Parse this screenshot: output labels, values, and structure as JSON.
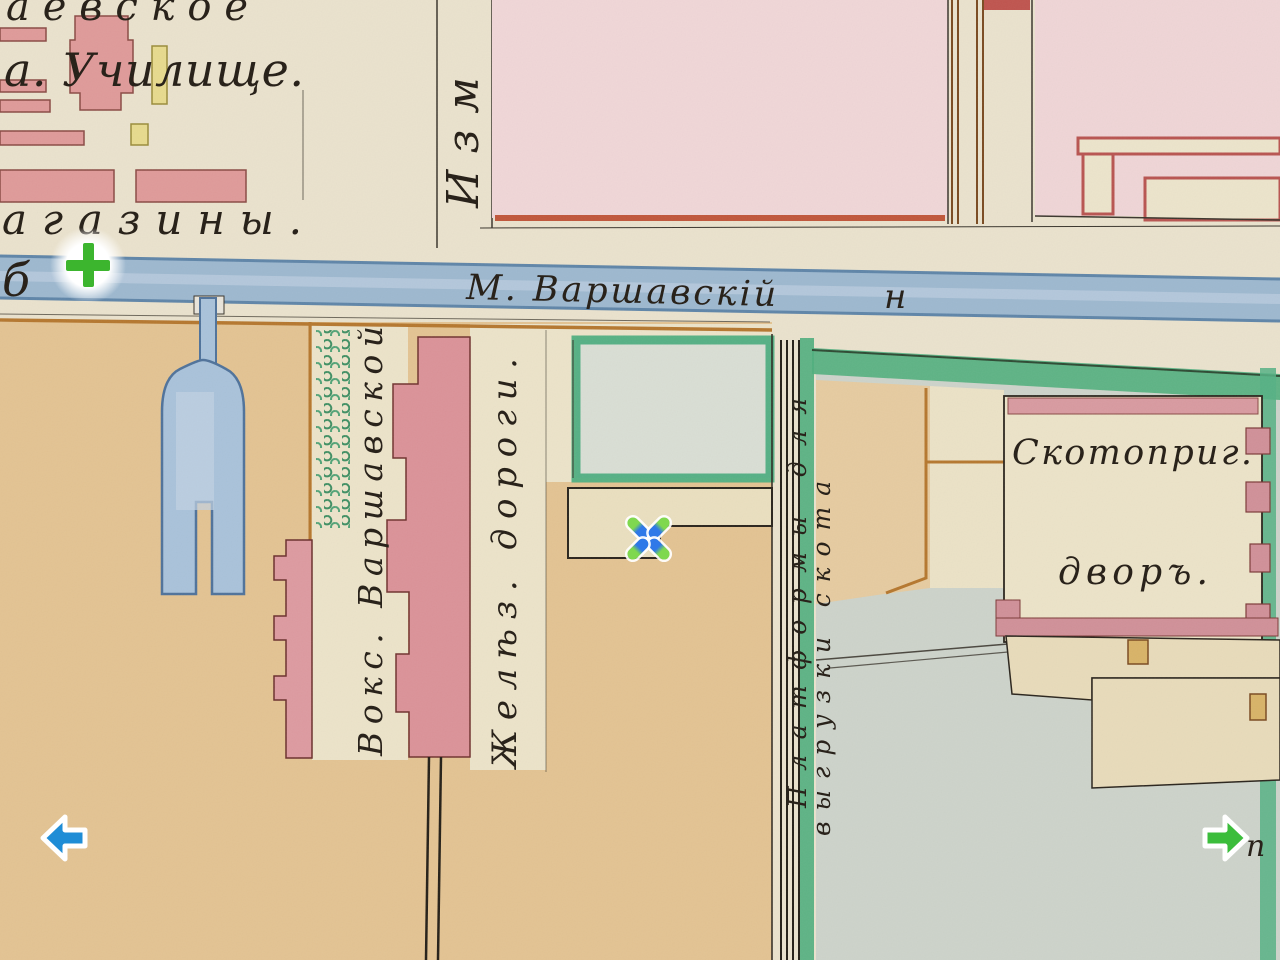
{
  "map": {
    "labels": {
      "top_left_fragment": "аевское",
      "school": "а. Училище.",
      "magazines": "агазины.",
      "street_top_vertical": "Изм",
      "canal_name": "М. Варшавскій",
      "canal_suffix": "н",
      "canal_left_fragment": "б",
      "station_line1": "Вокс. Варшавской",
      "station_line2": "Желѣз. дороги.",
      "platform_line1": "Платформы для",
      "platform_line2": "выгрузки скота",
      "cattle_line1": "Скотоприг.",
      "cattle_line2": "дворъ.",
      "bottom_right_fragment": "п"
    },
    "colors": {
      "paper": "#eae2cd",
      "building_red": "#df9a99",
      "block_pink": "#f0d6d7",
      "red_outline": "#8a4a44",
      "yard_tan": "#e3c392",
      "water_blue": "#9db8cf",
      "pond_blue": "#a9c2da",
      "road_green": "#4fae7d",
      "grounds_gray": "#cdd3ca",
      "boundary_orange": "#b5772e",
      "ink": "#241d15"
    }
  },
  "controls": {
    "zoom_in": {
      "icon": "plus-icon",
      "color": "#3cb52e"
    },
    "pan_left": {
      "icon": "arrow-left-icon",
      "color": "#1f8dd6"
    },
    "pan_right": {
      "icon": "arrow-right-icon",
      "color": "#3bbd3b"
    },
    "marker": {
      "icon": "x-marker-icon",
      "inner_color": "#2f79e8",
      "tip_color": "#7fd84f"
    }
  }
}
